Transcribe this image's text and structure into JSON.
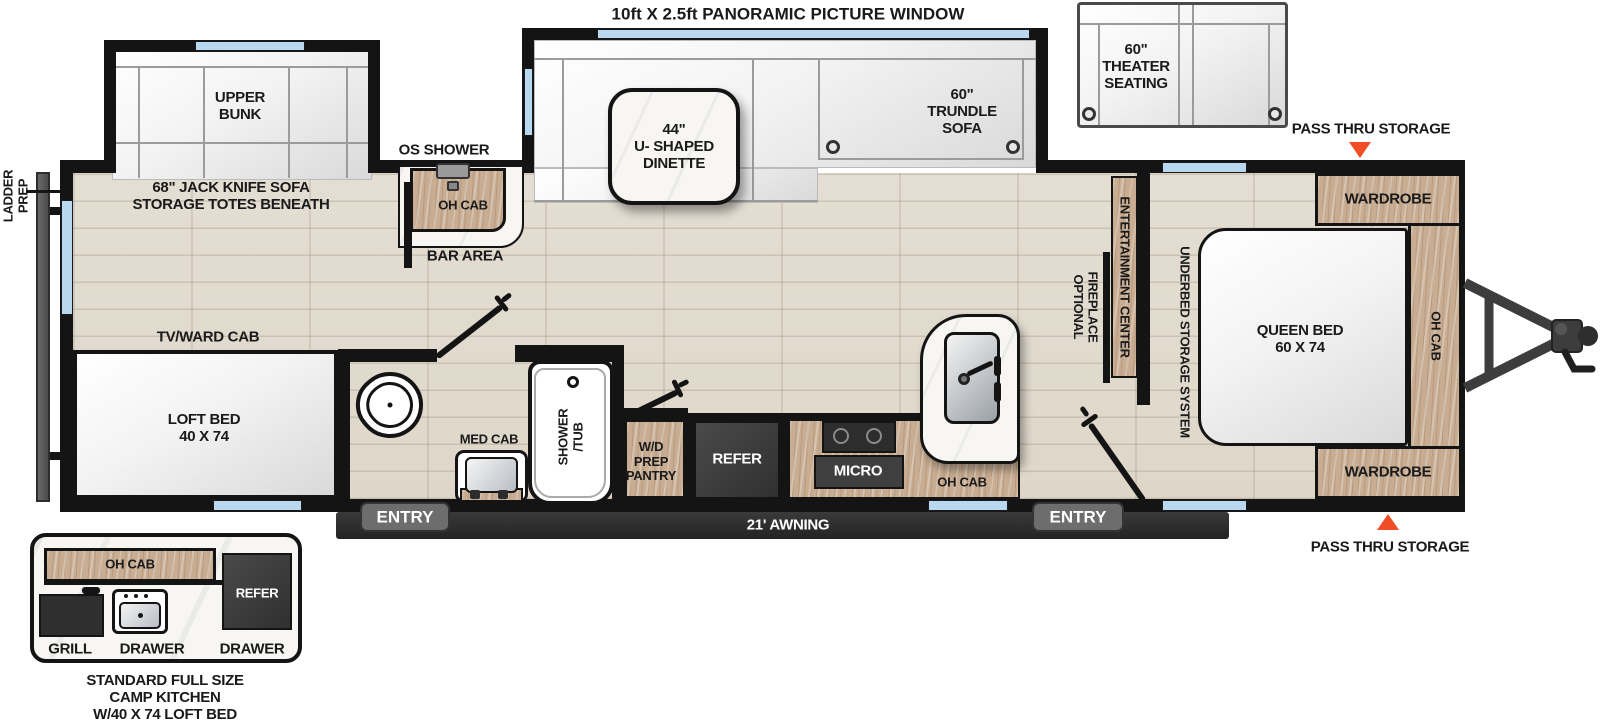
{
  "colors": {
    "wall": "#141414",
    "floor_wood": "#ded7c9",
    "cabinet_wood": "#c8ad92",
    "window_blue": "#b7d8ef",
    "accent_orange": "#f04c25",
    "appliance_dark": "#3f3f3f",
    "awning_dark": "#2b2b2b",
    "counter_marble": "#f7f6f2"
  },
  "header": {
    "panoramic_window": "10ft X 2.5ft PANORAMIC PICTURE WINDOW"
  },
  "exterior": {
    "ladder_prep": "LADDER\nPREP",
    "pass_thru_storage_top": "PASS THRU STORAGE",
    "pass_thru_storage_bottom": "PASS THRU STORAGE",
    "awning": "21' AWNING",
    "entry_rear": "ENTRY",
    "entry_front": "ENTRY"
  },
  "optional_furniture": {
    "theater_seating": "60\"\nTHEATER\nSEATING"
  },
  "living": {
    "upper_bunk": "UPPER\nBUNK",
    "jack_knife_sofa": "68\" JACK KNIFE SOFA\nSTORAGE TOTES BENEATH",
    "dinette": "44\"\nU- SHAPED\nDINETTE",
    "trundle_sofa": "60\"\nTRUNDLE\nSOFA",
    "tv_ward_cab": "TV/WARD CAB",
    "loft_bed": "LOFT BED\n40 X 74",
    "entertainment_center": "ENTERTAINMENT CENTER",
    "optional_fireplace": "OPTIONAL\nFIREPLACE"
  },
  "bar": {
    "os_shower": "OS SHOWER",
    "oh_cab": "OH CAB",
    "bar_area": "BAR AREA"
  },
  "bathroom": {
    "med_cab": "MED CAB",
    "shower_tub": "SHOWER\n/TUB"
  },
  "kitchen": {
    "wd_pantry": "W/D\nPREP\nPANTRY",
    "refer": "REFER",
    "micro": "MICRO",
    "oh_cab": "OH CAB"
  },
  "bedroom": {
    "queen_bed": "QUEEN BED\n60 X 74",
    "underbed_storage": "UNDERBED STORAGE SYSTEM",
    "wardrobe_top": "WARDROBE",
    "wardrobe_bottom": "WARDROBE",
    "oh_cab_front": "OH CAB"
  },
  "camp_kitchen": {
    "oh_cab": "OH CAB",
    "refer": "REFER",
    "grill": "GRILL",
    "drawer_left": "DRAWER",
    "drawer_right": "DRAWER",
    "caption": "STANDARD FULL SIZE\nCAMP KITCHEN\nW/40 X 74 LOFT BED"
  }
}
